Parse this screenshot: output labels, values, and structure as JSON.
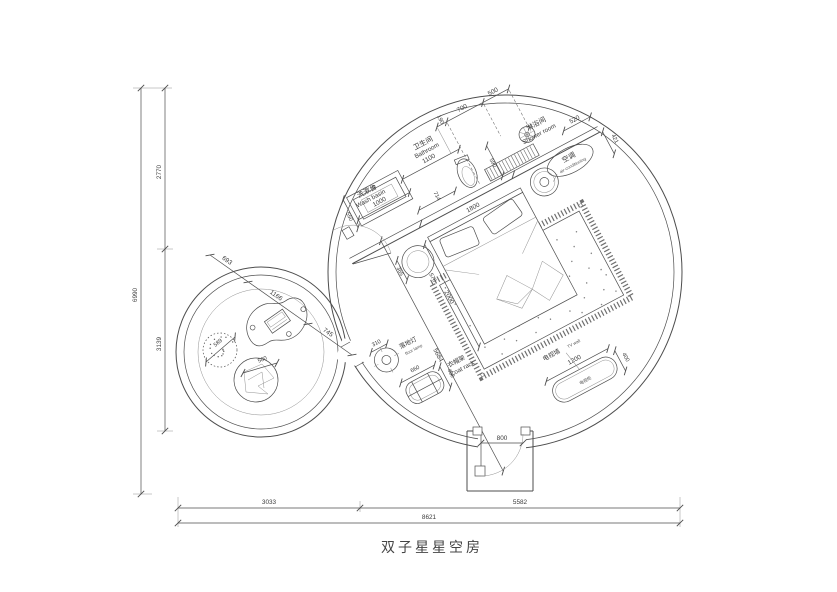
{
  "title": "双子星星空房",
  "labels": {
    "wash_basin_cn": "洗漱台",
    "wash_basin_en": "Wash basin",
    "bathroom_cn": "卫生间",
    "bathroom_en": "Bathroom",
    "shower_cn": "淋浴间",
    "shower_en": "Shower room",
    "ac_cn": "空调",
    "ac_en": "air-conditioning",
    "lamp_cn": "落地灯",
    "lamp_en": "floor lamp",
    "coat_cn": "衣帽架",
    "coat_en": "Coat rack",
    "tv_cn": "电视墙",
    "tv_en": "TV wall",
    "tv_cabinet_cn": "电视柜"
  },
  "dims": {
    "left_upper": "2770",
    "left_lower": "3139",
    "left_total": "6990",
    "bottom_left": "3033",
    "bottom_right": "5582",
    "bottom_total": "8621",
    "basin_width": "1000",
    "bathroom_width": "1100",
    "counter_depth": "550",
    "gap_714": "714",
    "shower_depth": "590",
    "chain_190": "190",
    "chain_700": "700",
    "chain_500": "500",
    "chain_520": "520",
    "chain_421": "421",
    "bed_width": "1800",
    "bed_length": "2000",
    "room_diag": "5684",
    "stool_365": "365",
    "stool_570": "570",
    "lamp_310": "310",
    "coat_660": "660",
    "coat_400": "400",
    "tv_1200": "1200",
    "tv_400": "400",
    "door_800": "800",
    "lounge_693": "693",
    "lounge_1166": "1166",
    "lounge_745": "745",
    "pouf_589": "589",
    "chair_500": "500"
  },
  "colors": {
    "line": "#4d4d4d",
    "text": "#3a3a3a"
  }
}
